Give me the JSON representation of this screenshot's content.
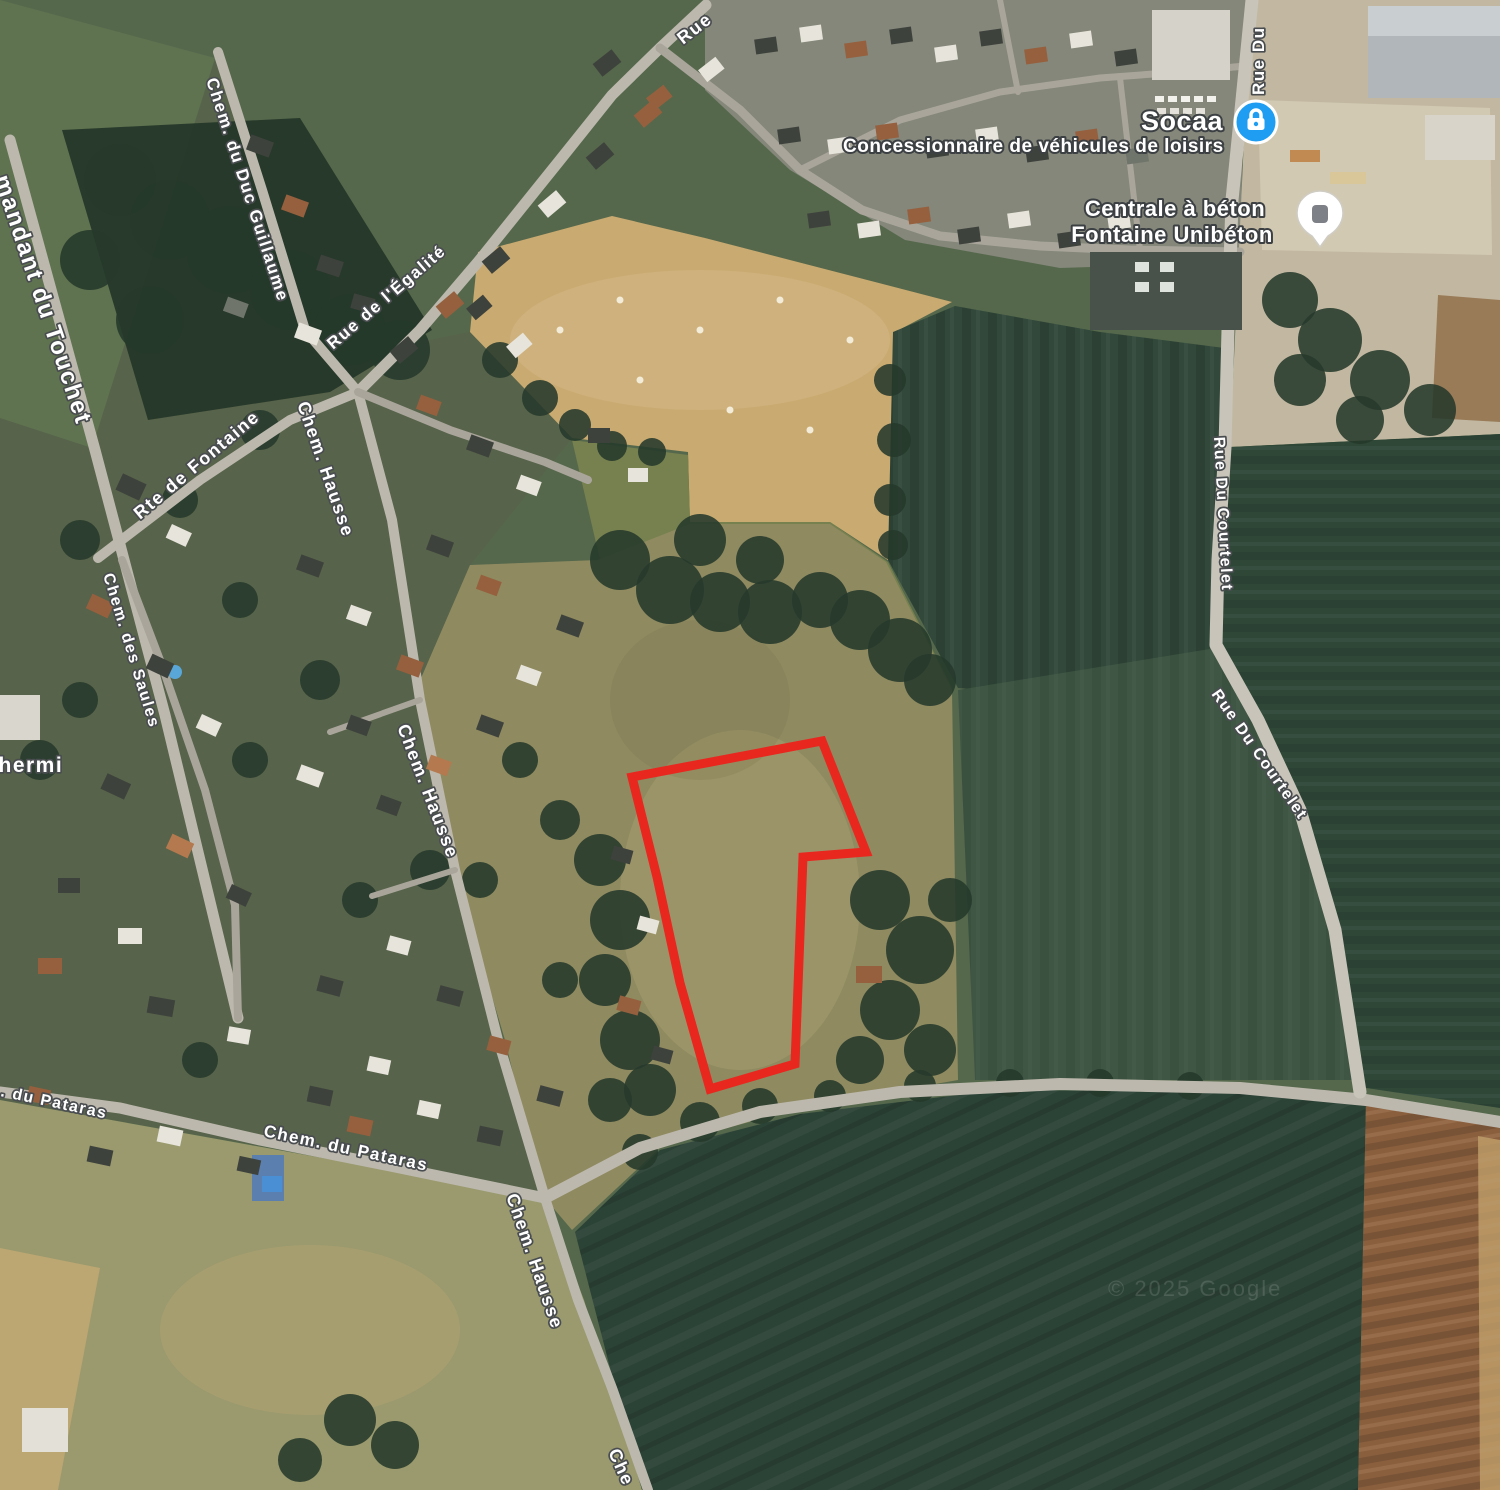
{
  "map": {
    "pois": {
      "socaa": {
        "title": "Socaa",
        "subtitle": "Concessionnaire de véhicules de loisirs"
      },
      "unibeton": {
        "line1": "Centrale à béton",
        "line2": "Fontaine Unibéton"
      }
    },
    "street_labels": {
      "rue_partial": "Rue",
      "rue_du_partial": "Rue Du",
      "touchet": "mandant du Touchet",
      "duc_guillaume": "Chem. du Duc Guillaume",
      "egalite": "Rue de l'Égalité",
      "fontaine": "Rte de Fontaine",
      "hausse_a": "Chem. Hausse",
      "hausse_b": "Chem. Hausse",
      "hausse_c": "Chem. Hausse",
      "hausse_d": "Che",
      "saules": "Chem. des Saules",
      "thermi": "thermi",
      "pataras_a": ". du Pataras",
      "pataras_b": "Chem. du Pataras",
      "courtelet_a": "Rue Du Courtelet",
      "courtelet_b": "Rue Du Courtelet"
    },
    "attribution": "© 2025 Google",
    "colors": {
      "parcel_outline": "#e8271f",
      "poi_blue": "#1f9df2",
      "road": "#bcb8ad"
    }
  }
}
